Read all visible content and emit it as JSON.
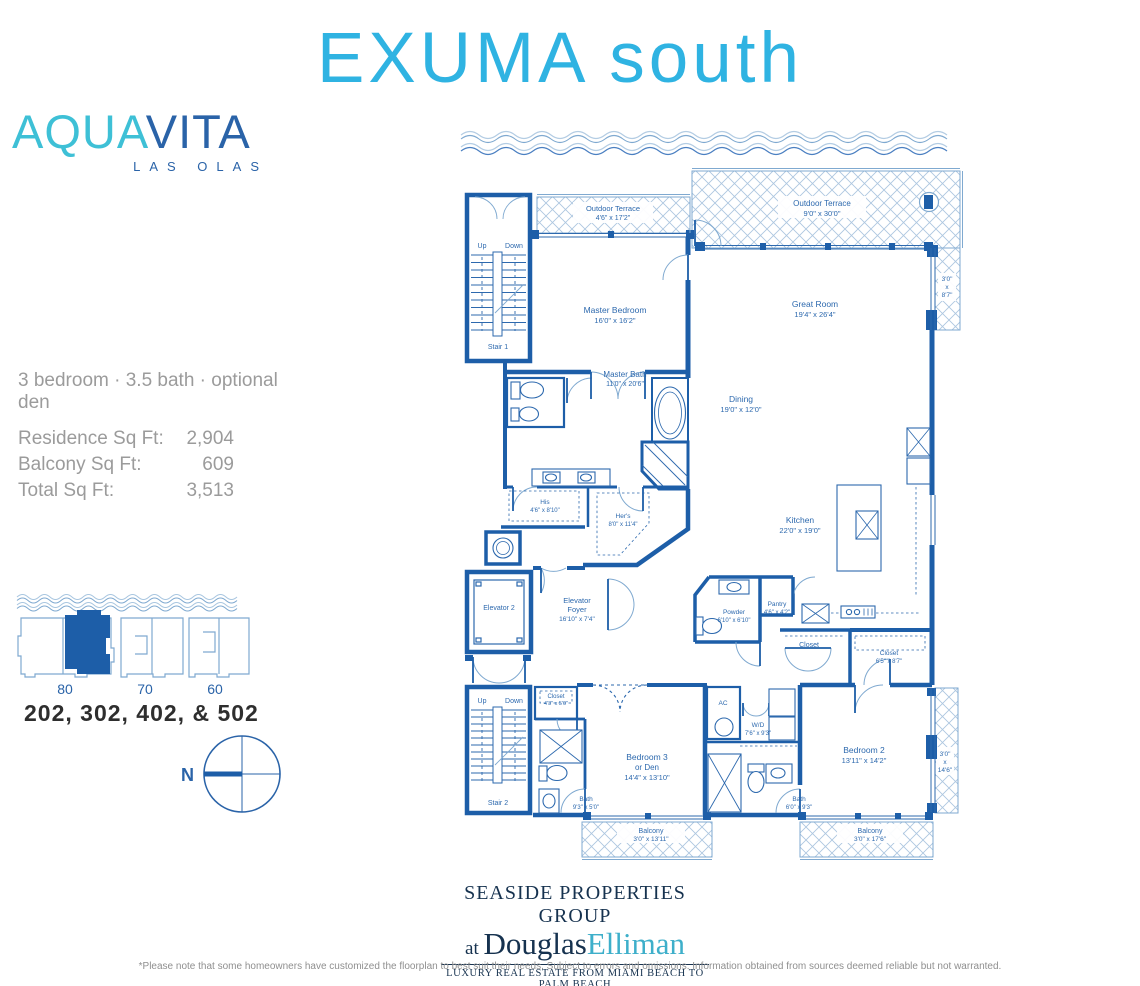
{
  "colors": {
    "title_cyan": "#2fb3e2",
    "logo_cyan": "#3ec0d6",
    "navy": "#2a63a8",
    "wall_blue": "#1d5ea8",
    "label_blue": "#2d69ae",
    "footer_navy": "#16324f",
    "elliman_cyan": "#3eafca",
    "gray_text": "#9b9b9b"
  },
  "header": {
    "title": "EXUMA south"
  },
  "logo": {
    "aqua": "AQUA",
    "vita": "VITA",
    "subtitle": "LAS OLAS"
  },
  "specs": {
    "summary": "3 bedroom · 3.5 bath · optional den",
    "rows": [
      {
        "label": "Residence Sq Ft:",
        "value": "2,904"
      },
      {
        "label": "Balcony Sq Ft:",
        "value": "609"
      },
      {
        "label": "Total Sq Ft:",
        "value": "3,513"
      }
    ]
  },
  "locator": {
    "buildings": [
      "80",
      "70",
      "60"
    ],
    "units_label": "202, 302, 402, & 502",
    "north_label": "N"
  },
  "floorplan": {
    "up": "Up",
    "down": "Down",
    "rooms": {
      "outdoor_terrace_left": {
        "name": "Outdoor Terrace",
        "dims": "4'6\" x 17'2\""
      },
      "outdoor_terrace_right": {
        "name": "Outdoor Terrace",
        "dims": "9'0\" x 30'0\""
      },
      "side_terrace_top": {
        "l1": "3'0\"",
        "l2": "x",
        "l3": "8'7\""
      },
      "side_terrace_bottom": {
        "l1": "3'0\"",
        "l2": "x",
        "l3": "14'6\""
      },
      "stair1": {
        "name": "Stair 1"
      },
      "stair2": {
        "name": "Stair 2"
      },
      "master_bedroom": {
        "name": "Master Bedroom",
        "dims": "16'0\" x 16'2\""
      },
      "great_room": {
        "name": "Great Room",
        "dims": "19'4\" x 26'4\""
      },
      "dining": {
        "name": "Dining",
        "dims": "19'0\" x 12'0\""
      },
      "master_bath": {
        "name": "Master Bath",
        "dims": "11'0\" x 20'6\""
      },
      "his_closet": {
        "name": "His",
        "dims": "4'6\" x 8'10\""
      },
      "hers_closet": {
        "name": "Her's",
        "dims": "8'0\" x 11'4\""
      },
      "kitchen": {
        "name": "Kitchen",
        "dims": "22'0\" x 19'0\""
      },
      "elevator2": {
        "name": "Elevator 2"
      },
      "elevator_foyer": {
        "l1": "Elevator",
        "l2": "Foyer",
        "dims": "16'10\" x 7'4\""
      },
      "powder": {
        "name": "Powder",
        "dims": "6'10\" x 6'10\""
      },
      "pantry": {
        "name": "Pantry",
        "dims": "4'6\" x 4'2\""
      },
      "closet_center": {
        "name": "Closet"
      },
      "closet_bedroom2": {
        "name": "Closet",
        "dims": "6'5\" x 8'7\""
      },
      "closet_bedroom3": {
        "name": "Closet",
        "dims": "4'3\" x 5'0\""
      },
      "bedroom3": {
        "l1": "Bedroom 3",
        "l2": "or Den",
        "dims": "14'4\" x 13'10\""
      },
      "ac": {
        "name": "AC"
      },
      "wd": {
        "name": "W/D",
        "dims": "7'6\" x 9'3\""
      },
      "bath3": {
        "name": "Bath",
        "dims": "9'3\" x 5'0\""
      },
      "bath2": {
        "name": "Bath",
        "dims": "6'0\" x 9'3\""
      },
      "bedroom2": {
        "name": "Bedroom 2",
        "dims": "13'11\" x 14'2\""
      },
      "balcony_left": {
        "name": "Balcony",
        "dims": "3'0\" x 13'11\""
      },
      "balcony_right": {
        "name": "Balcony",
        "dims": "3'0\" x 17'6\""
      }
    }
  },
  "footer": {
    "line1": "SEASIDE PROPERTIES GROUP",
    "at": "at ",
    "name1": "Douglas",
    "name2": "Elliman",
    "tagline": "LUXURY REAL ESTATE FROM MIAMI BEACH TO PALM BEACH"
  },
  "disclaimer": "*Please note that some homeowners have customized the floorplan to best suit their needs. Subject to errors and omissions. Information obtained from sources deemed reliable but not warranted."
}
